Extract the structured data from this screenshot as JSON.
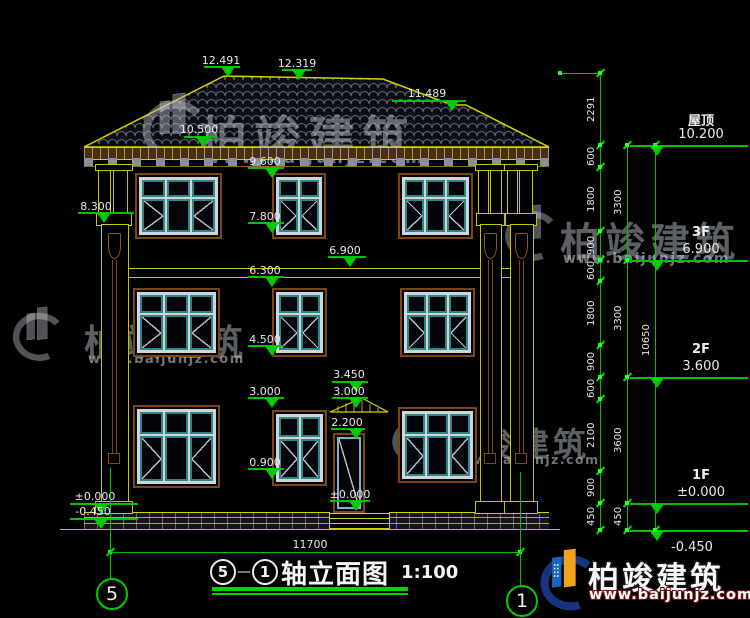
{
  "drawing": {
    "title_axis_start": "5",
    "title_axis_end": "1",
    "title_dash": "—",
    "title_text": "轴立面图",
    "title_scale": "1:100",
    "overall_width_dim": "11700",
    "axis_bubble_left": "5",
    "axis_bubble_right": "1"
  },
  "levels": [
    {
      "name": "屋顶",
      "value": "10.200"
    },
    {
      "name": "3F",
      "value": "6.900"
    },
    {
      "name": "2F",
      "value": "3.600"
    },
    {
      "name": "1F",
      "value": "±0.000"
    },
    {
      "name": "",
      "value": "-0.450"
    }
  ],
  "elevation_marks": {
    "ridge_left": "12.491",
    "ridge_right": "12.319",
    "hip_right": "11.489",
    "eave": "10.500",
    "win3_head": "9.600",
    "pilaster_capital": "8.300",
    "win3_sill": "7.800",
    "floor3_soffit": "6.900",
    "band": "6.300",
    "win2_sill": "4.500",
    "canopy_top": "3.450",
    "win1_head": "3.000",
    "canopy_base": "3.000",
    "door_head": "2.200",
    "win1_sill": "0.900",
    "door_base": "±0.000",
    "ground_left": "±0.000",
    "grade_left": "-0.450"
  },
  "dim_chain_inner": [
    "2291",
    "600",
    "1800",
    "900",
    "600",
    "1800",
    "900",
    "600",
    "2100",
    "900",
    "450"
  ],
  "dim_chain_middle": [
    "3300",
    "3300",
    "3600",
    "450"
  ],
  "dim_chain_overall": "10650",
  "watermark": {
    "brand": "柏竣建筑",
    "url": "www.baijunjz.com"
  },
  "logo": {
    "brand": "柏竣建筑",
    "url": "www.baijunjz.com"
  }
}
